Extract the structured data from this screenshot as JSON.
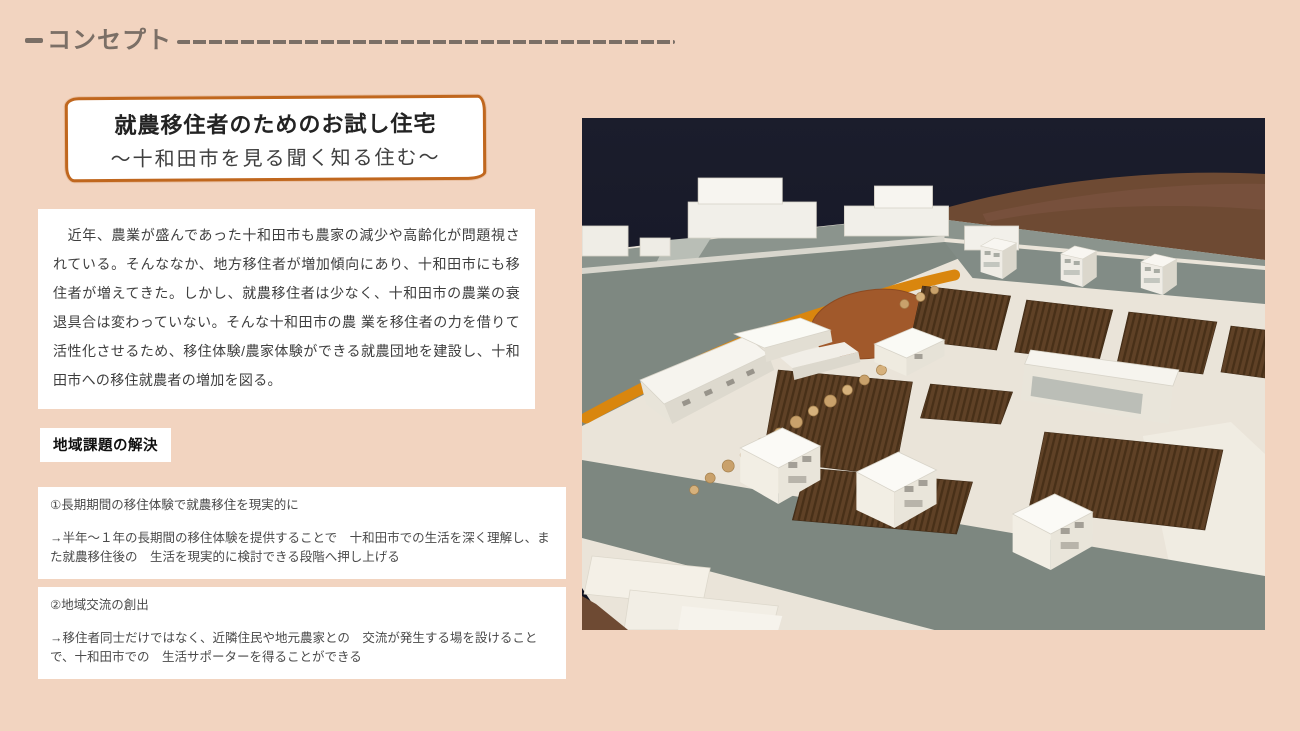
{
  "slide": {
    "background_color": "#f2d4c0",
    "header": {
      "label": "コンセプト",
      "color": "#7b6f66"
    },
    "title_card": {
      "border_color": "#c0671e",
      "title": "就農移住者のためのお試し住宅",
      "subtitle": "〜十和田市を見る聞く知る住む〜"
    },
    "intro_card": {
      "text": "　近年、農業が盛んであった十和田市も農家の減少や高齢化が問題視されている。そんななか、地方移住者が増加傾向にあり、十和田市にも移住者が増えてきた。しかし、就農移住者は少なく、十和田市の農業の衰退具合は変わっていない。そんな十和田市の農 業を移住者の力を借りて活性化させるため、移住体験/農家体験ができる就農団地を建設し、十和田市への移住就農者の増加を図る。"
    },
    "section_label": {
      "text": "地域課題の解決"
    },
    "point_cards": [
      {
        "heading": "①長期期間の移住体験で就農移住を現実的に",
        "body": "→半年〜１年の長期間の移住体験を提供することで　十和田市での生活を深く理解し、また就農移住後の　生活を現実的に検討できる段階へ押し上げる"
      },
      {
        "heading": "②地域交流の創出",
        "body": "→移住者同士だけではなく、近隣住民や地元農家との　交流が発生する場を設けることで、十和田市での　生活サポーターを得ることができる"
      }
    ],
    "photo": {
      "description": "Photo of an architectural scale model: white houses and community buildings, brown plowed farm fields, an orange promenade and oval plaza on a gray-green site board, set on a wooden table against a dark backdrop",
      "colors": {
        "backdrop": "#161724",
        "table_wood": "#6e4a33",
        "model_base": "#eae4d9",
        "road": "#7e8881",
        "promenade_orange": "#d9860e",
        "plaza": "#a1592b",
        "field_brown": "#5c3e23",
        "building_white": "#f4f1ea"
      }
    }
  }
}
